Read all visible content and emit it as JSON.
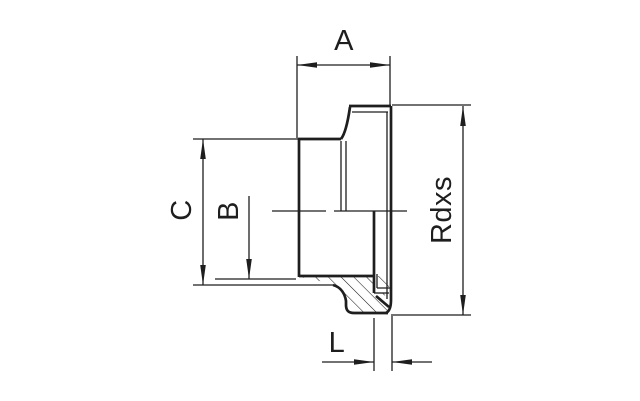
{
  "drawing": {
    "description": "technical drawing of threaded fitting",
    "labels": {
      "a": "A",
      "c": "C",
      "b": "B",
      "rdxs": "Rdxs",
      "l": "L"
    },
    "colors": {
      "line": "#1e1e1e",
      "background": "#ffffff"
    }
  }
}
